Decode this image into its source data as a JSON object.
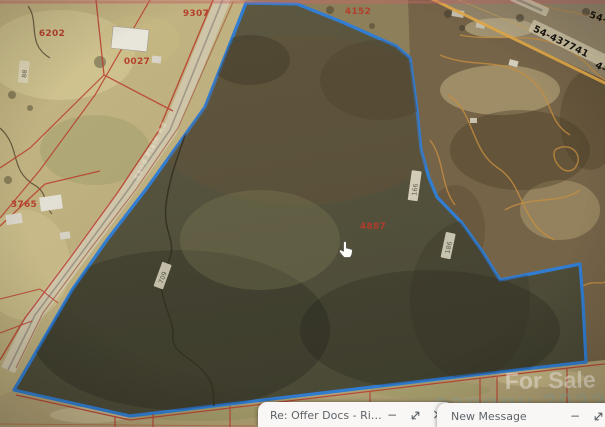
{
  "map": {
    "type": "county-gis-aerial-parcel-view",
    "colors": {
      "selected_parcel_outline": "#2e7ed7",
      "parcel_lines": "#bf3b2b",
      "contour_lines": "#c98f3a"
    },
    "parcel_numbers": [
      {
        "text": "6202"
      },
      {
        "text": "9307"
      },
      {
        "text": "0027"
      },
      {
        "text": "4152"
      },
      {
        "text": "3765"
      },
      {
        "text": "4887"
      }
    ],
    "survey_numbers": [
      {
        "text": "54-437741"
      },
      {
        "text": "54-"
      },
      {
        "text": "4-"
      }
    ],
    "road_label": {
      "text": "Sand Plain Rd"
    },
    "small_labels": [
      {
        "text": "166"
      },
      {
        "text": "186"
      },
      {
        "text": "709"
      },
      {
        "text": "88"
      }
    ],
    "watermarks": {
      "for_sale": "For Sale",
      "brand": "canopy 2023"
    },
    "cursor": "hand-pointer"
  },
  "compose_windows": [
    {
      "title": "Re: Offer Docs - Ridgec...",
      "controls": [
        "minimize",
        "pop-out",
        "close"
      ]
    },
    {
      "title": "New Message",
      "controls": [
        "minimize",
        "pop-out",
        "close"
      ]
    }
  ],
  "glyphs": {
    "minimize": "−",
    "close": "×"
  }
}
